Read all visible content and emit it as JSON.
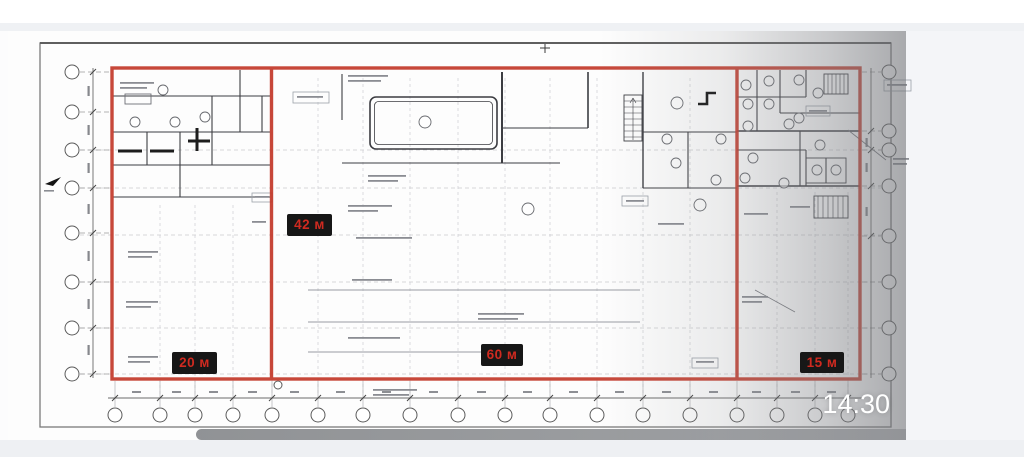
{
  "photo": {
    "timestamp": "14:30",
    "badges": [
      {
        "label": "42 м"
      },
      {
        "label": "20 м"
      },
      {
        "label": "60 м"
      },
      {
        "label": "15 м"
      }
    ]
  },
  "colors": {
    "overlay_red": "#c33a2b",
    "badge_background": "#171717",
    "badge_text": "#d02a20",
    "timestamp_text": "#ffffff"
  }
}
